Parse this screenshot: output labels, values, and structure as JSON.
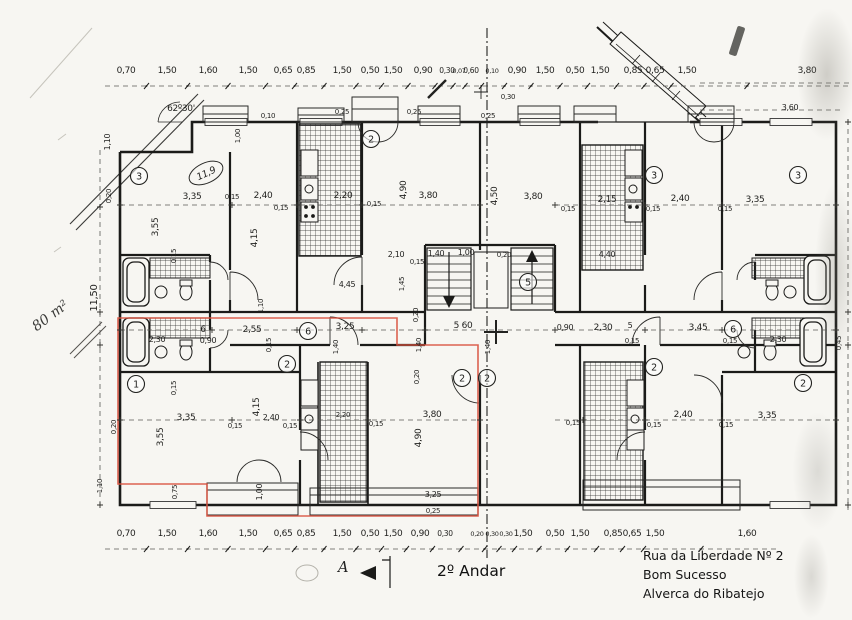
{
  "doc": {
    "floor_title": "2º Andar",
    "section_label": "A",
    "area_note": "80 m²",
    "room_area_note": "11,9",
    "angle_note": "62º30'",
    "address": [
      "Rua da Liberdade Nº 2",
      "Bom Sucesso",
      "Alverca do Ribatejo"
    ]
  },
  "colors": {
    "ink": "#1f1f1d",
    "highlight": "#d8523f",
    "paper": "#f7f6f2"
  },
  "dim_rows": {
    "top": {
      "y": 73,
      "labels": [
        {
          "t": "0,70",
          "x": 126
        },
        {
          "t": "1,50",
          "x": 167
        },
        {
          "t": "1,60",
          "x": 208
        },
        {
          "t": "1,50",
          "x": 248
        },
        {
          "t": "0,65",
          "x": 283
        },
        {
          "t": "0,85",
          "x": 306
        },
        {
          "t": "1,50",
          "x": 342
        },
        {
          "t": "0,50",
          "x": 370
        },
        {
          "t": "1,50",
          "x": 393
        },
        {
          "t": "0,90",
          "x": 423
        },
        {
          "t": "0,30",
          "x": 447,
          "s": 7.5
        },
        {
          "t": "0,07",
          "x": 459,
          "s": 6.5
        },
        {
          "t": "0,60",
          "x": 471,
          "s": 7.5
        },
        {
          "t": "0,10",
          "x": 492,
          "s": 6.5
        },
        {
          "t": "0,90",
          "x": 517
        },
        {
          "t": "1,50",
          "x": 545
        },
        {
          "t": "0,50",
          "x": 575
        },
        {
          "t": "1,50",
          "x": 600
        },
        {
          "t": "0,85",
          "x": 633
        },
        {
          "t": "0,65",
          "x": 655
        },
        {
          "t": "1,50",
          "x": 687
        },
        {
          "t": "3,80",
          "x": 807
        }
      ]
    },
    "bottom": {
      "y": 536,
      "labels": [
        {
          "t": "0,70",
          "x": 126
        },
        {
          "t": "1,50",
          "x": 167
        },
        {
          "t": "1,60",
          "x": 208
        },
        {
          "t": "1,50",
          "x": 248
        },
        {
          "t": "0,65",
          "x": 283
        },
        {
          "t": "0,85",
          "x": 306
        },
        {
          "t": "1,50",
          "x": 342
        },
        {
          "t": "0,50",
          "x": 370
        },
        {
          "t": "1,50",
          "x": 393
        },
        {
          "t": "0,90",
          "x": 420
        },
        {
          "t": "0,30",
          "x": 445,
          "s": 7.5
        },
        {
          "t": "0,20",
          "x": 477,
          "s": 6.5
        },
        {
          "t": "0,30",
          "x": 492,
          "s": 6.5
        },
        {
          "t": "0,30",
          "x": 506,
          "s": 6.5
        },
        {
          "t": "1,50",
          "x": 523
        },
        {
          "t": "0,50",
          "x": 555
        },
        {
          "t": "1,50",
          "x": 580
        },
        {
          "t": "0,85",
          "x": 613
        },
        {
          "t": "0,65",
          "x": 632
        },
        {
          "t": "1,50",
          "x": 655
        },
        {
          "t": "1,60",
          "x": 747
        }
      ]
    }
  },
  "labels": [
    {
      "t": "0,25",
      "x": 342,
      "y": 114,
      "s": 7
    },
    {
      "t": "0,25",
      "x": 414,
      "y": 114,
      "s": 7
    },
    {
      "t": "0,10",
      "x": 268,
      "y": 118,
      "s": 7
    },
    {
      "t": "1,00",
      "x": 240,
      "y": 136,
      "r": -90,
      "s": 7
    },
    {
      "t": "0,30",
      "x": 508,
      "y": 99,
      "s": 7
    },
    {
      "t": "0,25",
      "x": 488,
      "y": 118,
      "s": 7
    },
    {
      "t": "3,60",
      "x": 790,
      "y": 110,
      "s": 8
    },
    {
      "t": "1,10",
      "x": 110,
      "y": 142,
      "r": -90,
      "s": 8
    },
    {
      "t": "0,20",
      "x": 111,
      "y": 196,
      "r": -90,
      "s": 7
    },
    {
      "t": "11,50",
      "x": 97,
      "y": 298,
      "r": -90,
      "s": 10
    },
    {
      "t": "1,10",
      "x": 102,
      "y": 486,
      "r": -90,
      "s": 7
    },
    {
      "t": "3,35",
      "x": 192,
      "y": 199
    },
    {
      "t": "0,15",
      "x": 232,
      "y": 199,
      "s": 7
    },
    {
      "t": "2,40",
      "x": 263,
      "y": 198
    },
    {
      "t": "0,15",
      "x": 281,
      "y": 210,
      "s": 7
    },
    {
      "t": "3,55",
      "x": 158,
      "y": 227,
      "r": -90
    },
    {
      "t": "4,15",
      "x": 257,
      "y": 238,
      "r": -90
    },
    {
      "t": "0,15",
      "x": 176,
      "y": 256,
      "r": -90,
      "s": 7
    },
    {
      "t": "2,20",
      "x": 343,
      "y": 198
    },
    {
      "t": "0,15",
      "x": 374,
      "y": 206,
      "s": 7
    },
    {
      "t": "4,90",
      "x": 406,
      "y": 190,
      "r": -90
    },
    {
      "t": "3,80",
      "x": 428,
      "y": 198
    },
    {
      "t": "2,10",
      "x": 396,
      "y": 257,
      "s": 8
    },
    {
      "t": "0,15",
      "x": 417,
      "y": 264,
      "s": 7
    },
    {
      "t": "1,40",
      "x": 436,
      "y": 256,
      "s": 8
    },
    {
      "t": "1,00",
      "x": 466,
      "y": 255,
      "s": 8
    },
    {
      "t": "0,20",
      "x": 504,
      "y": 257,
      "s": 7
    },
    {
      "t": "4,45",
      "x": 347,
      "y": 287,
      "s": 8
    },
    {
      "t": "1,45",
      "x": 404,
      "y": 284,
      "r": -90,
      "s": 7
    },
    {
      "t": "4,40",
      "x": 607,
      "y": 257,
      "s": 8
    },
    {
      "t": "4,50",
      "x": 497,
      "y": 196,
      "r": -90
    },
    {
      "t": "3,80",
      "x": 533,
      "y": 199
    },
    {
      "t": "2,15",
      "x": 607,
      "y": 202
    },
    {
      "t": "0,15",
      "x": 568,
      "y": 211,
      "s": 7
    },
    {
      "t": "2,40",
      "x": 680,
      "y": 201
    },
    {
      "t": "0,15",
      "x": 653,
      "y": 211,
      "s": 7
    },
    {
      "t": "3,35",
      "x": 755,
      "y": 202
    },
    {
      "t": "0,15",
      "x": 725,
      "y": 211,
      "s": 7
    },
    {
      "t": "6",
      "x": 203,
      "y": 332
    },
    {
      "t": "2,55",
      "x": 252,
      "y": 332
    },
    {
      "t": "0,90",
      "x": 208,
      "y": 343,
      "s": 8
    },
    {
      "t": "2,30",
      "x": 157,
      "y": 342,
      "s": 8
    },
    {
      "t": "1,10",
      "x": 263,
      "y": 306,
      "r": -90,
      "s": 7
    },
    {
      "t": "0,15",
      "x": 271,
      "y": 345,
      "r": -90,
      "s": 7
    },
    {
      "t": "3,25",
      "x": 345,
      "y": 329
    },
    {
      "t": "1,40",
      "x": 338,
      "y": 347,
      "r": -90,
      "s": 7
    },
    {
      "t": "0,20",
      "x": 418,
      "y": 315,
      "r": -90,
      "s": 7
    },
    {
      "t": "5 60",
      "x": 463,
      "y": 328
    },
    {
      "t": "1,40",
      "x": 421,
      "y": 345,
      "r": -90,
      "s": 7
    },
    {
      "t": "1,40",
      "x": 490,
      "y": 347,
      "r": -90,
      "s": 7
    },
    {
      "t": "0,90",
      "x": 565,
      "y": 330,
      "s": 8
    },
    {
      "t": "2,30",
      "x": 603,
      "y": 330
    },
    {
      "t": "5",
      "x": 630,
      "y": 328,
      "s": 8
    },
    {
      "t": "3,45",
      "x": 698,
      "y": 330
    },
    {
      "t": "0,15",
      "x": 632,
      "y": 343,
      "s": 7
    },
    {
      "t": "0,15",
      "x": 730,
      "y": 343,
      "s": 7
    },
    {
      "t": "2,30",
      "x": 778,
      "y": 342,
      "s": 8
    },
    {
      "t": "0,45",
      "x": 841,
      "y": 343,
      "r": -90,
      "s": 7
    },
    {
      "t": "3,35",
      "x": 186,
      "y": 420
    },
    {
      "t": "2,40",
      "x": 271,
      "y": 420,
      "s": 8
    },
    {
      "t": "0,15",
      "x": 235,
      "y": 428,
      "s": 7
    },
    {
      "t": "0,15",
      "x": 290,
      "y": 428,
      "s": 7
    },
    {
      "t": "3,55",
      "x": 163,
      "y": 437,
      "r": -90
    },
    {
      "t": "4,15",
      "x": 259,
      "y": 407,
      "r": -90
    },
    {
      "t": "0,15",
      "x": 176,
      "y": 388,
      "r": -90,
      "s": 7
    },
    {
      "t": "0,20",
      "x": 116,
      "y": 427,
      "r": -90,
      "s": 7
    },
    {
      "t": "0,75",
      "x": 177,
      "y": 492,
      "r": -90,
      "s": 7
    },
    {
      "t": "1,00",
      "x": 262,
      "y": 492,
      "r": -90,
      "s": 8
    },
    {
      "t": "0,20",
      "x": 419,
      "y": 377,
      "r": -90,
      "s": 7
    },
    {
      "t": "3,80",
      "x": 432,
      "y": 417
    },
    {
      "t": "4,90",
      "x": 421,
      "y": 438,
      "r": -90
    },
    {
      "t": "0,15",
      "x": 376,
      "y": 426,
      "s": 7
    },
    {
      "t": "2,20",
      "x": 343,
      "y": 417,
      "s": 7
    },
    {
      "t": "3,25",
      "x": 433,
      "y": 497,
      "s": 8
    },
    {
      "t": "0,25",
      "x": 433,
      "y": 513,
      "s": 7
    },
    {
      "t": "2,40",
      "x": 683,
      "y": 417
    },
    {
      "t": "3,35",
      "x": 767,
      "y": 418
    },
    {
      "t": "0,15",
      "x": 573,
      "y": 425,
      "s": 7
    },
    {
      "t": "0,15",
      "x": 654,
      "y": 427,
      "s": 7
    },
    {
      "t": "0,15",
      "x": 726,
      "y": 427,
      "s": 7
    }
  ],
  "badges": [
    {
      "t": "3",
      "x": 139,
      "y": 176
    },
    {
      "t": "2",
      "x": 371,
      "y": 139
    },
    {
      "t": "3",
      "x": 654,
      "y": 175
    },
    {
      "t": "3",
      "x": 798,
      "y": 175
    },
    {
      "t": "5",
      "x": 528,
      "y": 282
    },
    {
      "t": "6",
      "x": 308,
      "y": 331
    },
    {
      "t": "6",
      "x": 733,
      "y": 329
    },
    {
      "t": "2",
      "x": 287,
      "y": 364
    },
    {
      "t": "1",
      "x": 136,
      "y": 384
    },
    {
      "t": "2",
      "x": 462,
      "y": 378
    },
    {
      "t": "2",
      "x": 487,
      "y": 378
    },
    {
      "t": "2",
      "x": 654,
      "y": 367
    },
    {
      "t": "2",
      "x": 803,
      "y": 383
    }
  ],
  "cross_marks": [
    [
      120,
      330
    ],
    [
      212,
      330
    ],
    [
      297,
      330
    ],
    [
      362,
      330
    ],
    [
      425,
      330
    ],
    [
      555,
      330
    ],
    [
      645,
      330
    ],
    [
      722,
      330
    ],
    [
      836,
      330
    ],
    [
      120,
      205
    ],
    [
      232,
      205
    ],
    [
      297,
      205
    ],
    [
      362,
      205
    ],
    [
      480,
      205
    ],
    [
      555,
      205
    ],
    [
      645,
      205
    ],
    [
      722,
      205
    ],
    [
      836,
      205
    ],
    [
      120,
      420
    ],
    [
      232,
      420
    ],
    [
      300,
      420
    ],
    [
      368,
      420
    ],
    [
      480,
      420
    ],
    [
      583,
      420
    ],
    [
      645,
      420
    ],
    [
      722,
      420
    ],
    [
      836,
      420
    ],
    [
      100,
      207
    ],
    [
      100,
      312
    ],
    [
      100,
      345
    ],
    [
      100,
      505
    ],
    [
      848,
      122
    ],
    [
      848,
      312
    ],
    [
      848,
      345
    ],
    [
      848,
      505
    ]
  ]
}
